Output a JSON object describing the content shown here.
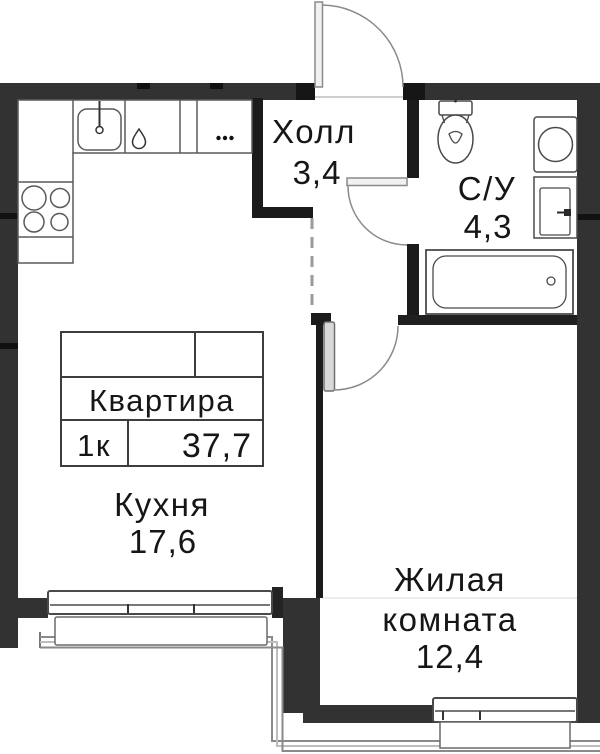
{
  "floor_plan": {
    "unit_card": {
      "title": "Квартира",
      "rooms_count": "1к",
      "total_area": "37,7"
    },
    "rooms": {
      "hall": {
        "name": "Холл",
        "area": "3,4"
      },
      "bathroom": {
        "name": "С/У",
        "area": "4,3"
      },
      "kitchen": {
        "name": "Кухня",
        "area": "17,6"
      },
      "living": {
        "name_line1": "Жилая",
        "name_line2": "комната",
        "area": "12,4"
      }
    },
    "fixtures": [
      "kitchen-sink",
      "dishwasher-drop",
      "cooktop-4-burner",
      "counter-dots",
      "toilet",
      "washing-machine",
      "wash-basin",
      "bathtub",
      "entrance-door",
      "bathroom-door",
      "living-room-door",
      "kitchen-window",
      "living-room-window",
      "balcony-outline"
    ],
    "colors": {
      "wall_gray": "#323232",
      "wall_black": "#1b1b1b",
      "fixture_outline": "#4a4a4a",
      "door_arc": "#8a8a8a",
      "door_leaf_light": "#f1f1f1",
      "door_leaf_gray": "#d8d8d8",
      "balcony_line": "#8a8a8a",
      "text": "#161616",
      "background": "#ffffff"
    }
  }
}
